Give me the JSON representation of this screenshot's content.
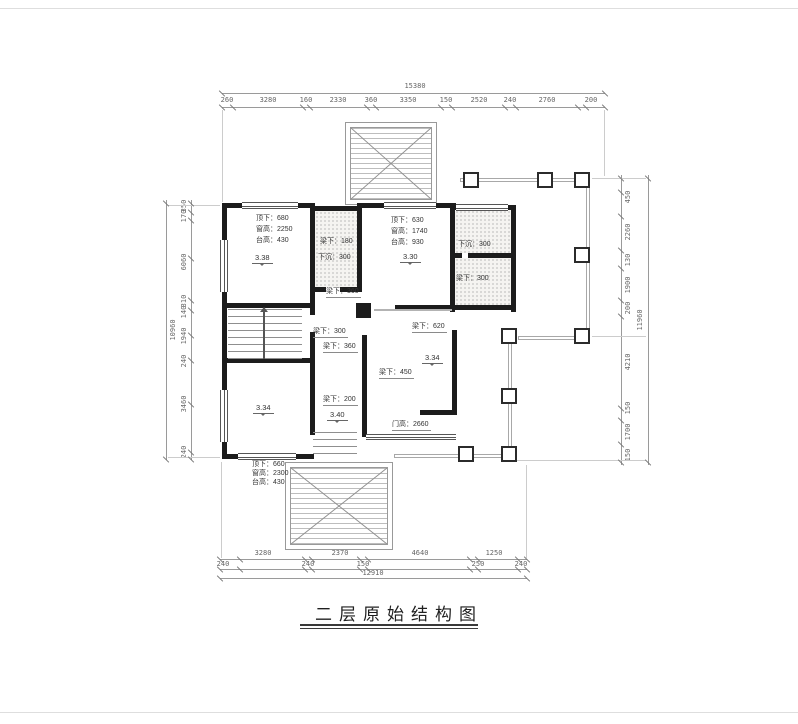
{
  "title": "二层原始结构图",
  "dims": {
    "top": {
      "total": "15380",
      "segments": [
        "260",
        "3280",
        "160",
        "2330",
        "360",
        "3350",
        "150",
        "2520",
        "240",
        "2760",
        "200"
      ]
    },
    "left": {
      "total": "10960",
      "segments": [
        "350",
        "170",
        "6060",
        "310",
        "140",
        "1940",
        "240",
        "3460",
        "240"
      ]
    },
    "right": {
      "total": "11960",
      "segments": [
        "450",
        "2260",
        "130",
        "1900",
        "200",
        "4210",
        "150",
        "1700",
        "150"
      ]
    },
    "bottom": {
      "total": "12910",
      "row1": [
        "3280",
        "2370",
        "4640",
        "1250"
      ],
      "row2": [
        "240",
        "240",
        "150",
        "250",
        "240"
      ]
    }
  },
  "rooms": {
    "top_left": {
      "lines": [
        "顶下：680",
        "窗高：2250",
        "台高：430"
      ],
      "level": "3.38"
    },
    "bath_left": {
      "lines": [
        "梁下：180",
        "下沉：300"
      ]
    },
    "top_middle": {
      "lines": [
        "顶下：630",
        "窗高：1740",
        "台高：930"
      ],
      "level": "3.30"
    },
    "bath_right": {
      "lines": [
        "下沉：300",
        "梁下：300"
      ]
    },
    "center": {
      "level": "3.34"
    },
    "hall": {
      "level": "3.40"
    },
    "bottom_left": {
      "level": "3.34",
      "lines": [
        "顶下：660",
        "窗高：2300",
        "台高：430"
      ]
    },
    "beam_labels": [
      "梁下：360",
      "梁下：300",
      "梁下：360",
      "梁下：620",
      "梁下：450",
      "梁下：200"
    ],
    "door_label": "门高：2660"
  }
}
